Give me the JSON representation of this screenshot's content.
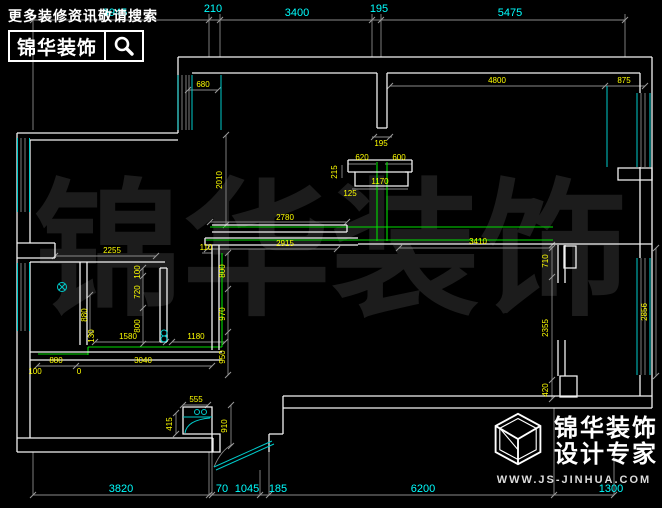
{
  "branding": {
    "top": {
      "hint": "更多装修资讯敬请搜索",
      "logo": "锦华装饰"
    },
    "bottom": {
      "brand": "锦华装饰",
      "tagline": "设计专家",
      "website": "WWW.JS-JINHUA.COM"
    }
  },
  "watermark": {
    "chars": [
      "锦",
      "华",
      "装",
      "饰"
    ]
  },
  "colors": {
    "background": "#000000",
    "walls": "#f2f2f2",
    "dim_chain_text": "#00ffff",
    "interior_dim_text": "#ffff00",
    "wiring_lines": "#00dd00",
    "window_lines": "#00cccc",
    "dim_lines": "#8a8a8a",
    "watermark": "#1c1c1c"
  },
  "floorplan": {
    "unit": "mm",
    "dimension_chains": {
      "top": [
        3945,
        210,
        3400,
        195,
        5475
      ],
      "bottom": [
        3820,
        70,
        1045,
        185,
        6200,
        1300
      ]
    },
    "labels": [
      {
        "t": "3945",
        "x": 115,
        "y": 16,
        "r": 0,
        "c": "c"
      },
      {
        "t": "210",
        "x": 213,
        "y": 12,
        "r": 0,
        "c": "c"
      },
      {
        "t": "3400",
        "x": 297,
        "y": 16,
        "r": 0,
        "c": "c"
      },
      {
        "t": "195",
        "x": 379,
        "y": 12,
        "r": 0,
        "c": "c"
      },
      {
        "t": "5475",
        "x": 510,
        "y": 16,
        "r": 0,
        "c": "c"
      },
      {
        "t": "3820",
        "x": 121,
        "y": 492,
        "r": 0,
        "c": "c"
      },
      {
        "t": "70",
        "x": 222,
        "y": 492,
        "r": 0,
        "c": "c"
      },
      {
        "t": "1045",
        "x": 247,
        "y": 492,
        "r": 0,
        "c": "c"
      },
      {
        "t": "185",
        "x": 278,
        "y": 492,
        "r": 0,
        "c": "c"
      },
      {
        "t": "6200",
        "x": 423,
        "y": 492,
        "r": 0,
        "c": "c"
      },
      {
        "t": "1300",
        "x": 611,
        "y": 492,
        "r": 0,
        "c": "c"
      },
      {
        "t": "680",
        "x": 203,
        "y": 87,
        "r": 0,
        "c": "y"
      },
      {
        "t": "2010",
        "x": 222,
        "y": 180,
        "r": -90,
        "c": "y"
      },
      {
        "t": "4800",
        "x": 497,
        "y": 83,
        "r": 0,
        "c": "y"
      },
      {
        "t": "875",
        "x": 624,
        "y": 83,
        "r": 0,
        "c": "y"
      },
      {
        "t": "195",
        "x": 381,
        "y": 146,
        "r": 0,
        "c": "y"
      },
      {
        "t": "620",
        "x": 362,
        "y": 160,
        "r": 0,
        "c": "y"
      },
      {
        "t": "600",
        "x": 399,
        "y": 160,
        "r": 0,
        "c": "y"
      },
      {
        "t": "215",
        "x": 337,
        "y": 172,
        "r": -90,
        "c": "y"
      },
      {
        "t": "1170",
        "x": 380,
        "y": 184,
        "r": 0,
        "c": "y"
      },
      {
        "t": "125",
        "x": 350,
        "y": 196,
        "r": 0,
        "c": "y"
      },
      {
        "t": "2780",
        "x": 285,
        "y": 220,
        "r": 0,
        "c": "y"
      },
      {
        "t": "2915",
        "x": 285,
        "y": 246,
        "r": 0,
        "c": "y"
      },
      {
        "t": "3410",
        "x": 478,
        "y": 244,
        "r": 0,
        "c": "y"
      },
      {
        "t": "710",
        "x": 548,
        "y": 261,
        "r": -90,
        "c": "y"
      },
      {
        "t": "2355",
        "x": 548,
        "y": 328,
        "r": -90,
        "c": "y"
      },
      {
        "t": "420",
        "x": 548,
        "y": 390,
        "r": -90,
        "c": "y"
      },
      {
        "t": "2856",
        "x": 647,
        "y": 312,
        "r": -90,
        "c": "y"
      },
      {
        "t": "2255",
        "x": 112,
        "y": 253,
        "r": 0,
        "c": "y"
      },
      {
        "t": "110",
        "x": 206,
        "y": 250,
        "r": 0,
        "c": "y"
      },
      {
        "t": "800",
        "x": 225,
        "y": 271,
        "r": -90,
        "c": "y"
      },
      {
        "t": "970",
        "x": 225,
        "y": 314,
        "r": -90,
        "c": "y"
      },
      {
        "t": "950",
        "x": 225,
        "y": 357,
        "r": -90,
        "c": "y"
      },
      {
        "t": "100",
        "x": 140,
        "y": 272,
        "r": -90,
        "c": "y"
      },
      {
        "t": "720",
        "x": 140,
        "y": 292,
        "r": -90,
        "c": "y"
      },
      {
        "t": "800",
        "x": 140,
        "y": 326,
        "r": -90,
        "c": "y"
      },
      {
        "t": "880",
        "x": 87,
        "y": 315,
        "r": -90,
        "c": "y"
      },
      {
        "t": "130",
        "x": 94,
        "y": 336,
        "r": -90,
        "c": "y"
      },
      {
        "t": "1580",
        "x": 128,
        "y": 339,
        "r": 0,
        "c": "y"
      },
      {
        "t": "1180",
        "x": 196,
        "y": 339,
        "r": 0,
        "c": "y"
      },
      {
        "t": "880",
        "x": 56,
        "y": 363,
        "r": 0,
        "c": "y"
      },
      {
        "t": "3040",
        "x": 143,
        "y": 363,
        "r": 0,
        "c": "y"
      },
      {
        "t": "100",
        "x": 35,
        "y": 374,
        "r": 0,
        "c": "y"
      },
      {
        "t": "0",
        "x": 79,
        "y": 374,
        "r": 0,
        "c": "y"
      },
      {
        "t": "555",
        "x": 196,
        "y": 402,
        "r": 0,
        "c": "y"
      },
      {
        "t": "415",
        "x": 172,
        "y": 424,
        "r": -90,
        "c": "y"
      },
      {
        "t": "910",
        "x": 227,
        "y": 426,
        "r": -90,
        "c": "y"
      }
    ]
  }
}
